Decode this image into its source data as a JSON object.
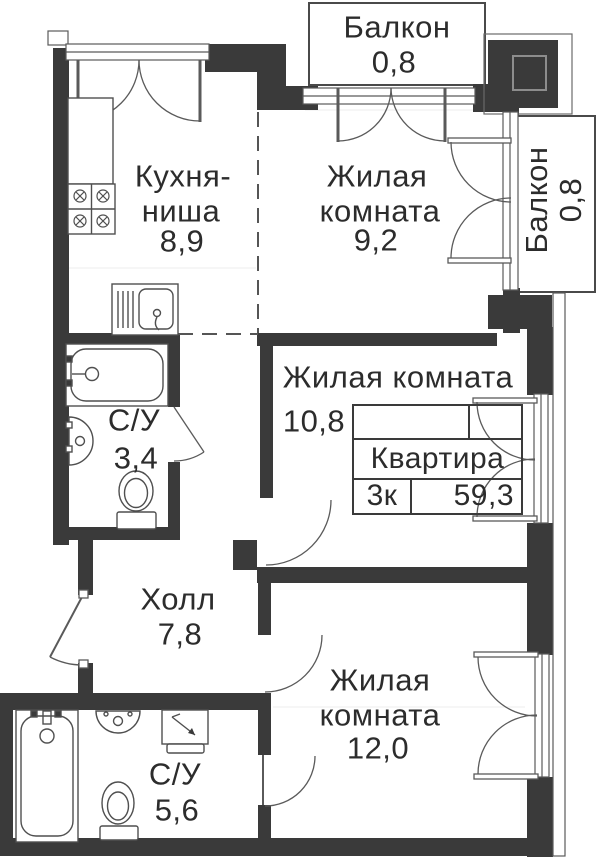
{
  "rooms": {
    "balcony_top": {
      "name": "Балкон",
      "area": "0,8"
    },
    "kitchen": {
      "name_line1": "Кухня-",
      "name_line2": "ниша",
      "area": "8,9"
    },
    "room_9": {
      "name_line1": "Жилая",
      "name_line2": "комната",
      "area": "9,2"
    },
    "balcony_right": {
      "name": "Балкон",
      "area": "0,8"
    },
    "room_10": {
      "name": "Жилая комната",
      "area": "10,8"
    },
    "bathroom_small": {
      "name": "С/У",
      "area": "3,4"
    },
    "hall": {
      "name": "Холл",
      "area": "7,8"
    },
    "room_12": {
      "name_line1": "Жилая",
      "name_line2": "комната",
      "area": "12,0"
    },
    "bathroom_large": {
      "name": "С/У",
      "area": "5,6"
    }
  },
  "apartment_card": {
    "title": "Квартира",
    "rooms_count": "3к",
    "total_area": "59,3"
  },
  "colors": {
    "wall": "#3a3a3a",
    "line": "#555555",
    "text": "#2c2c2c"
  }
}
